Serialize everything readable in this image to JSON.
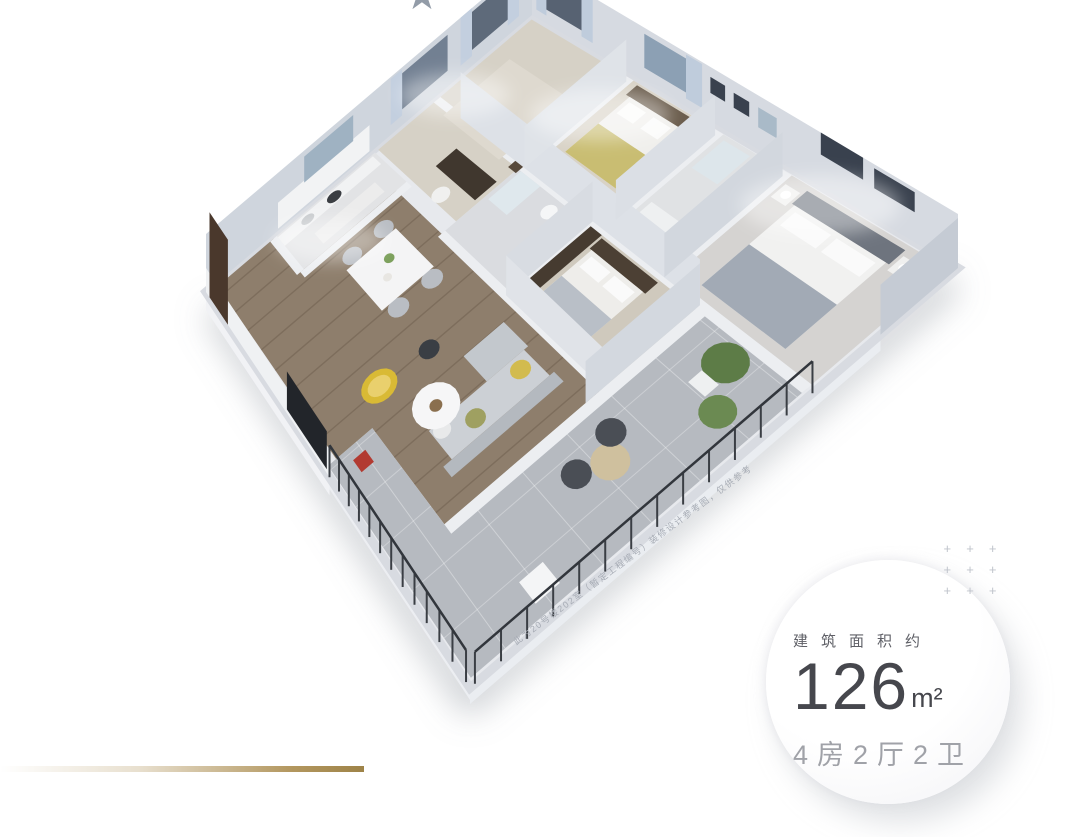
{
  "decor": {
    "star_char": "★",
    "plus_char": "+"
  },
  "floorplan": {
    "disclaimer": "此为20号楼202室（暂定工程编号）装修设计参考图，仅供参考"
  },
  "info_card": {
    "area_label": "建筑面积约",
    "area_value": "126",
    "area_unit": "m²",
    "layout_text": "4房2厅2卫"
  },
  "colors": {
    "accent_gold": "#b3975f",
    "text_primary": "#46474d",
    "text_secondary": "#a0a2a8",
    "plus_gray": "#bfc3cb"
  }
}
